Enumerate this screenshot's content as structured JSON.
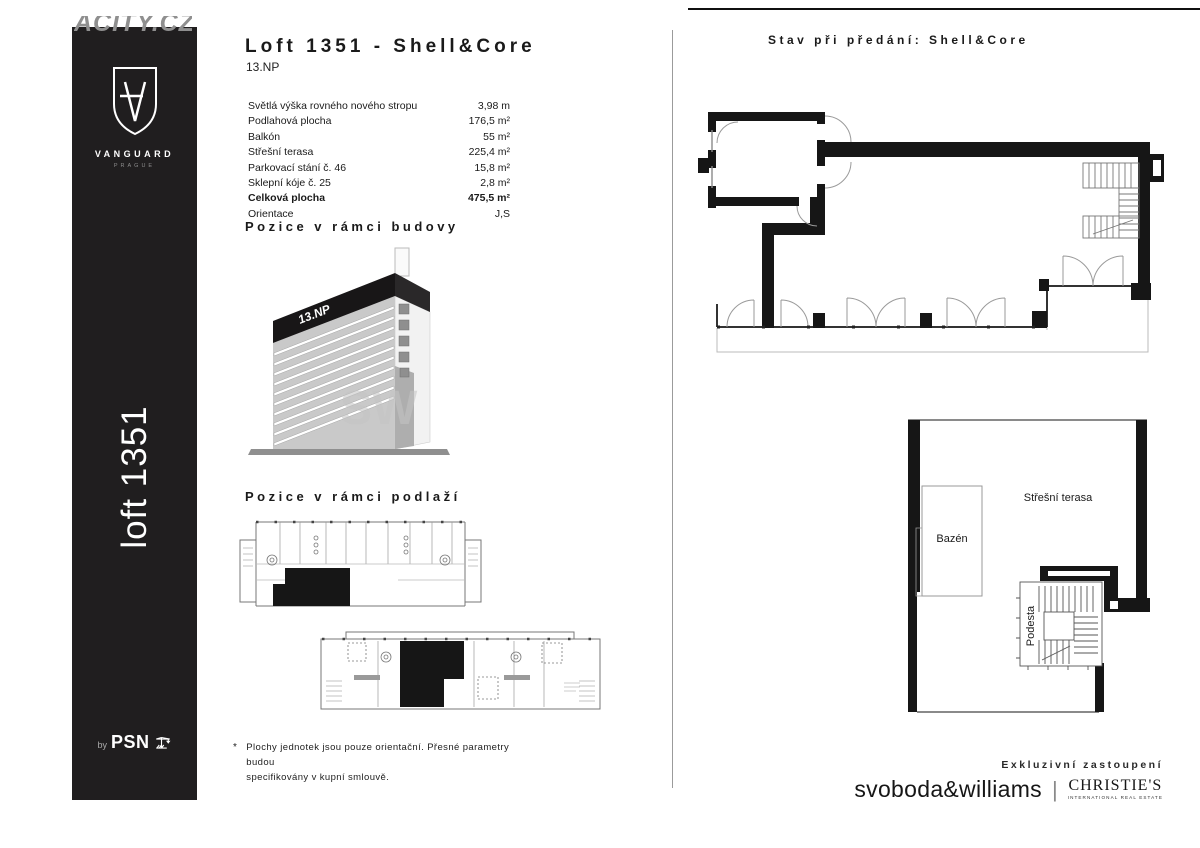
{
  "colors": {
    "wall": "#161616",
    "sidebar_bg": "#201e1f"
  },
  "watermark": {
    "top_text": "ACITY.CZ",
    "building_text": "SW"
  },
  "sidebar": {
    "brand": "VANGUARD",
    "brand_sub": "PRAGUE",
    "unit_label": "loft 1351",
    "by_label": "by",
    "psn_label": "PSN"
  },
  "header": {
    "title": "Loft 1351 - Shell&Core",
    "floor": "13.NP"
  },
  "specs": {
    "rows": [
      {
        "label": "Světlá výška rovného nového stropu",
        "value": "3,98 m"
      },
      {
        "label": "Podlahová plocha",
        "value": "176,5 m²"
      },
      {
        "label": "Balkón",
        "value": "55 m²"
      },
      {
        "label": "Střešní terasa",
        "value": "225,4 m²"
      },
      {
        "label": "Parkovací stání č. 46",
        "value": "15,8 m²"
      },
      {
        "label": "Sklepní kóje č. 25",
        "value": "2,8 m²"
      },
      {
        "label": "Celková plocha",
        "value": "475,5 m²"
      },
      {
        "label": "Orientace",
        "value": "J,S"
      }
    ]
  },
  "sections": {
    "building_position": "Pozice v rámci budovy",
    "floor_position": "Pozice v rámci podlaží"
  },
  "building": {
    "floor_label": "13.NP"
  },
  "footnote": {
    "marker": "*",
    "line1": "Plochy jednotek jsou pouze orientační. Přesné parametry budou",
    "line2": "specifikovány v kupní smlouvě."
  },
  "right": {
    "header": "Stav při předání: Shell&Core",
    "roof_labels": {
      "terrace": "Střešní terasa",
      "pool": "Bazén",
      "landing": "Podesta"
    }
  },
  "footer": {
    "exclusive": "Exkluzivní zastoupení",
    "agency": "svoboda&williams",
    "divider": "|",
    "christies": "CHRISTIE'S",
    "christies_sub": "INTERNATIONAL REAL ESTATE"
  }
}
